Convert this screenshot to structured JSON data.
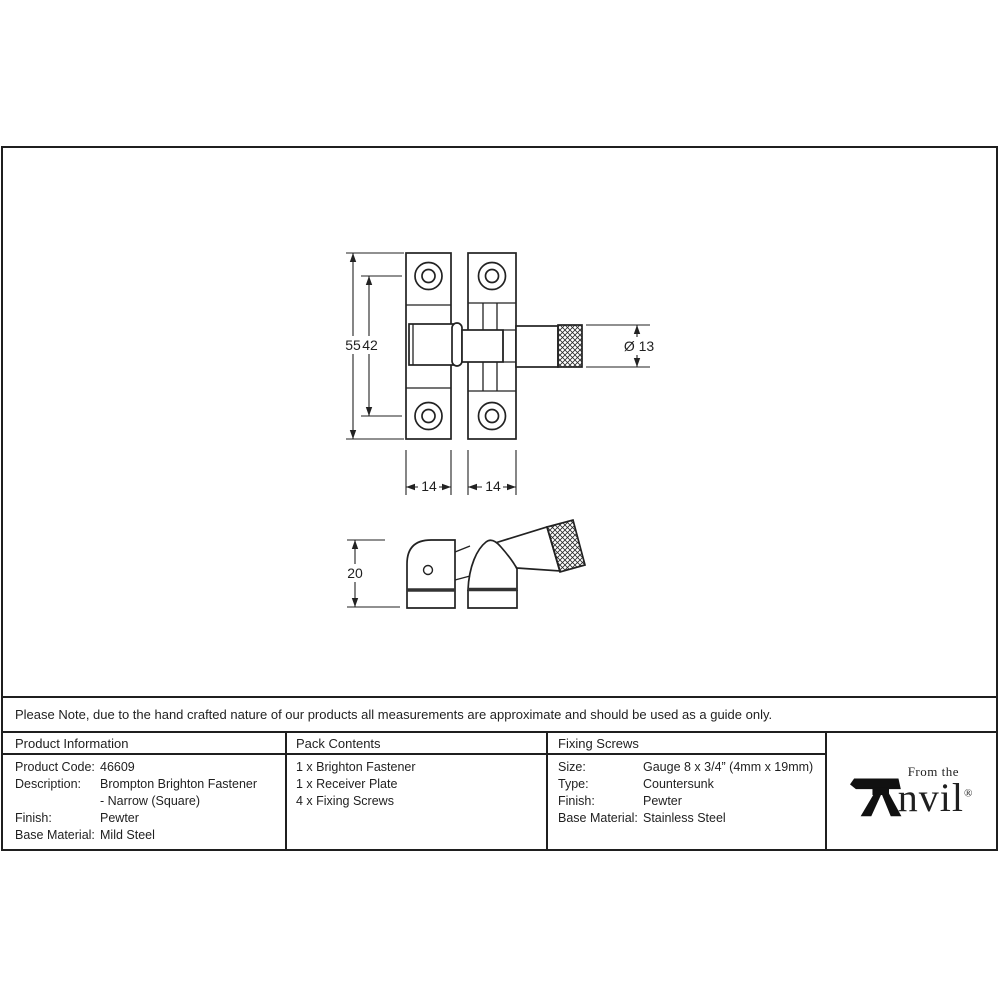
{
  "drawing": {
    "top_view": {
      "overall_height": "55",
      "hole_spacing": "42",
      "knob_diameter": "Ø 13",
      "left_plate_width": "14",
      "right_plate_width": "14"
    },
    "side_view": {
      "height": "20"
    }
  },
  "note": {
    "text": "Please Note, due to the hand crafted nature of our products all measurements are approximate and should be used as a guide only."
  },
  "table": {
    "headers": [
      "Product Information",
      "Pack Contents",
      "Fixing Screws"
    ],
    "product_information": [
      {
        "label": "Product Code:",
        "value": "46609"
      },
      {
        "label": "Description:",
        "value": "Brompton Brighton Fastener",
        "value2": "- Narrow (Square)"
      },
      {
        "label": "Finish:",
        "value": "Pewter"
      },
      {
        "label": "Base Material:",
        "value": "Mild Steel"
      }
    ],
    "pack_contents": [
      "1 x Brighton Fastener",
      "1 x Receiver Plate",
      "4 x Fixing Screws"
    ],
    "fixing_screws": [
      {
        "label": "Size:",
        "value": "Gauge 8 x 3/4” (4mm x 19mm)"
      },
      {
        "label": "Type:",
        "value": "Countersunk"
      },
      {
        "label": "Finish:",
        "value": "Pewter"
      },
      {
        "label": "Base Material:",
        "value": "Stainless Steel"
      }
    ]
  },
  "logo": {
    "tagline": "From the",
    "brand": "nvil",
    "registered": "®"
  }
}
